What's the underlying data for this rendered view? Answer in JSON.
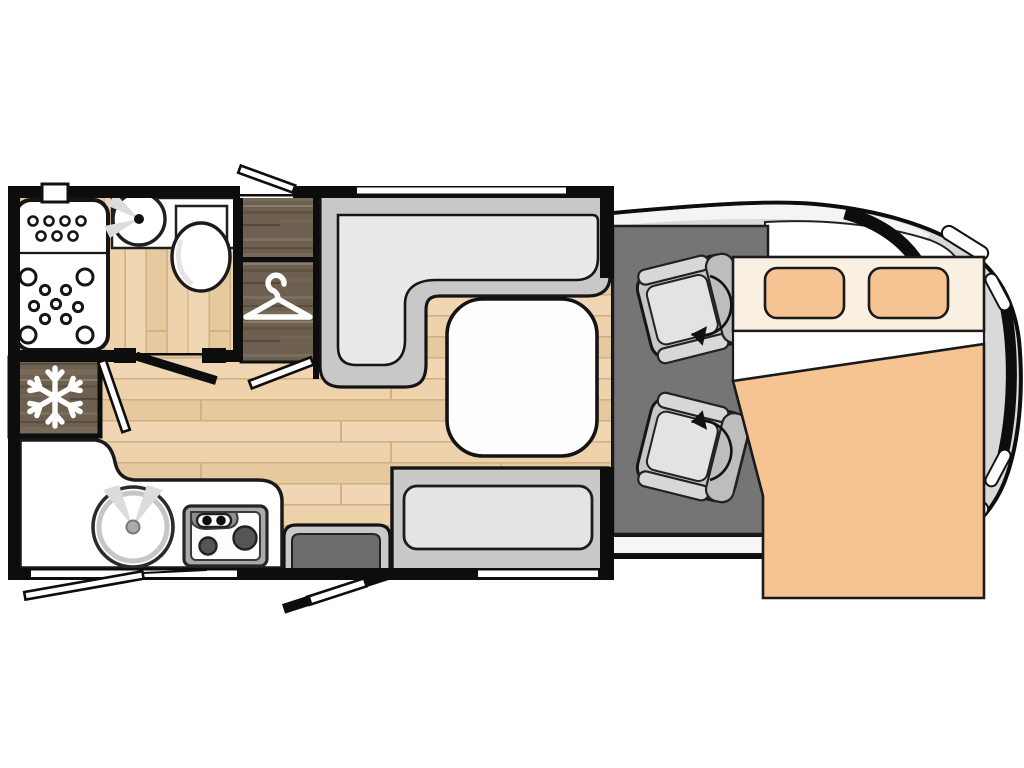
{
  "floorplan": {
    "title": "Motorhome floor plan (top view)",
    "vehicle": "coachbuilt motorhome",
    "colors": {
      "outline": "#0d0d0d",
      "floor_wood_light": "#ecd0aa",
      "floor_wood_line": "#d2b184",
      "cabinet_wood_dark": "#6e6050",
      "sofa_frame": "#c8c8c8",
      "sofa_cushion": "#e9e9e9",
      "cab_floor": "#757575",
      "van_body": "#d9d9d9",
      "bed_orange": "#f5c492",
      "bed_header_cream": "#faf0e2",
      "fixture_white": "#ffffff",
      "step_dark": "#6d6d6d",
      "burner_gray": "#555555"
    },
    "areas": {
      "bathroom": {
        "label": "washroom",
        "features": [
          "shower-tray",
          "basin",
          "toilet",
          "hinged-door"
        ]
      },
      "wardrobe": {
        "label": "wardrobe",
        "features": [
          "hanger-icon"
        ]
      },
      "fridge": {
        "label": "refrigerator",
        "features": [
          "snowflake-icon"
        ]
      },
      "kitchen": {
        "label": "kitchen",
        "features": [
          "round-sink",
          "two-burner-hob",
          "worktop"
        ]
      },
      "lounge": {
        "label": "lounge dinette",
        "features": [
          "l-shaped-sofa",
          "table",
          "bench-seat",
          "entry-step",
          "entry-door"
        ]
      },
      "cab": {
        "label": "driver cab",
        "features": [
          "swivel-seat-driver",
          "swivel-seat-passenger",
          "rotation-arrow-icon"
        ]
      },
      "bed": {
        "label": "double bed over cab",
        "features": [
          "pillow",
          "pillow",
          "duvet"
        ]
      }
    },
    "icons": [
      "snowflake-icon",
      "hanger-icon",
      "rotation-arrow-icon",
      "burner-icon",
      "window-flap-icon"
    ],
    "windows": {
      "top_wall": 2,
      "bottom_wall": 2,
      "open_flaps": 2
    },
    "doors": {
      "entry_door": "bottom wall, open",
      "bathroom_door": "interior, open",
      "partition_doors": 2
    }
  }
}
